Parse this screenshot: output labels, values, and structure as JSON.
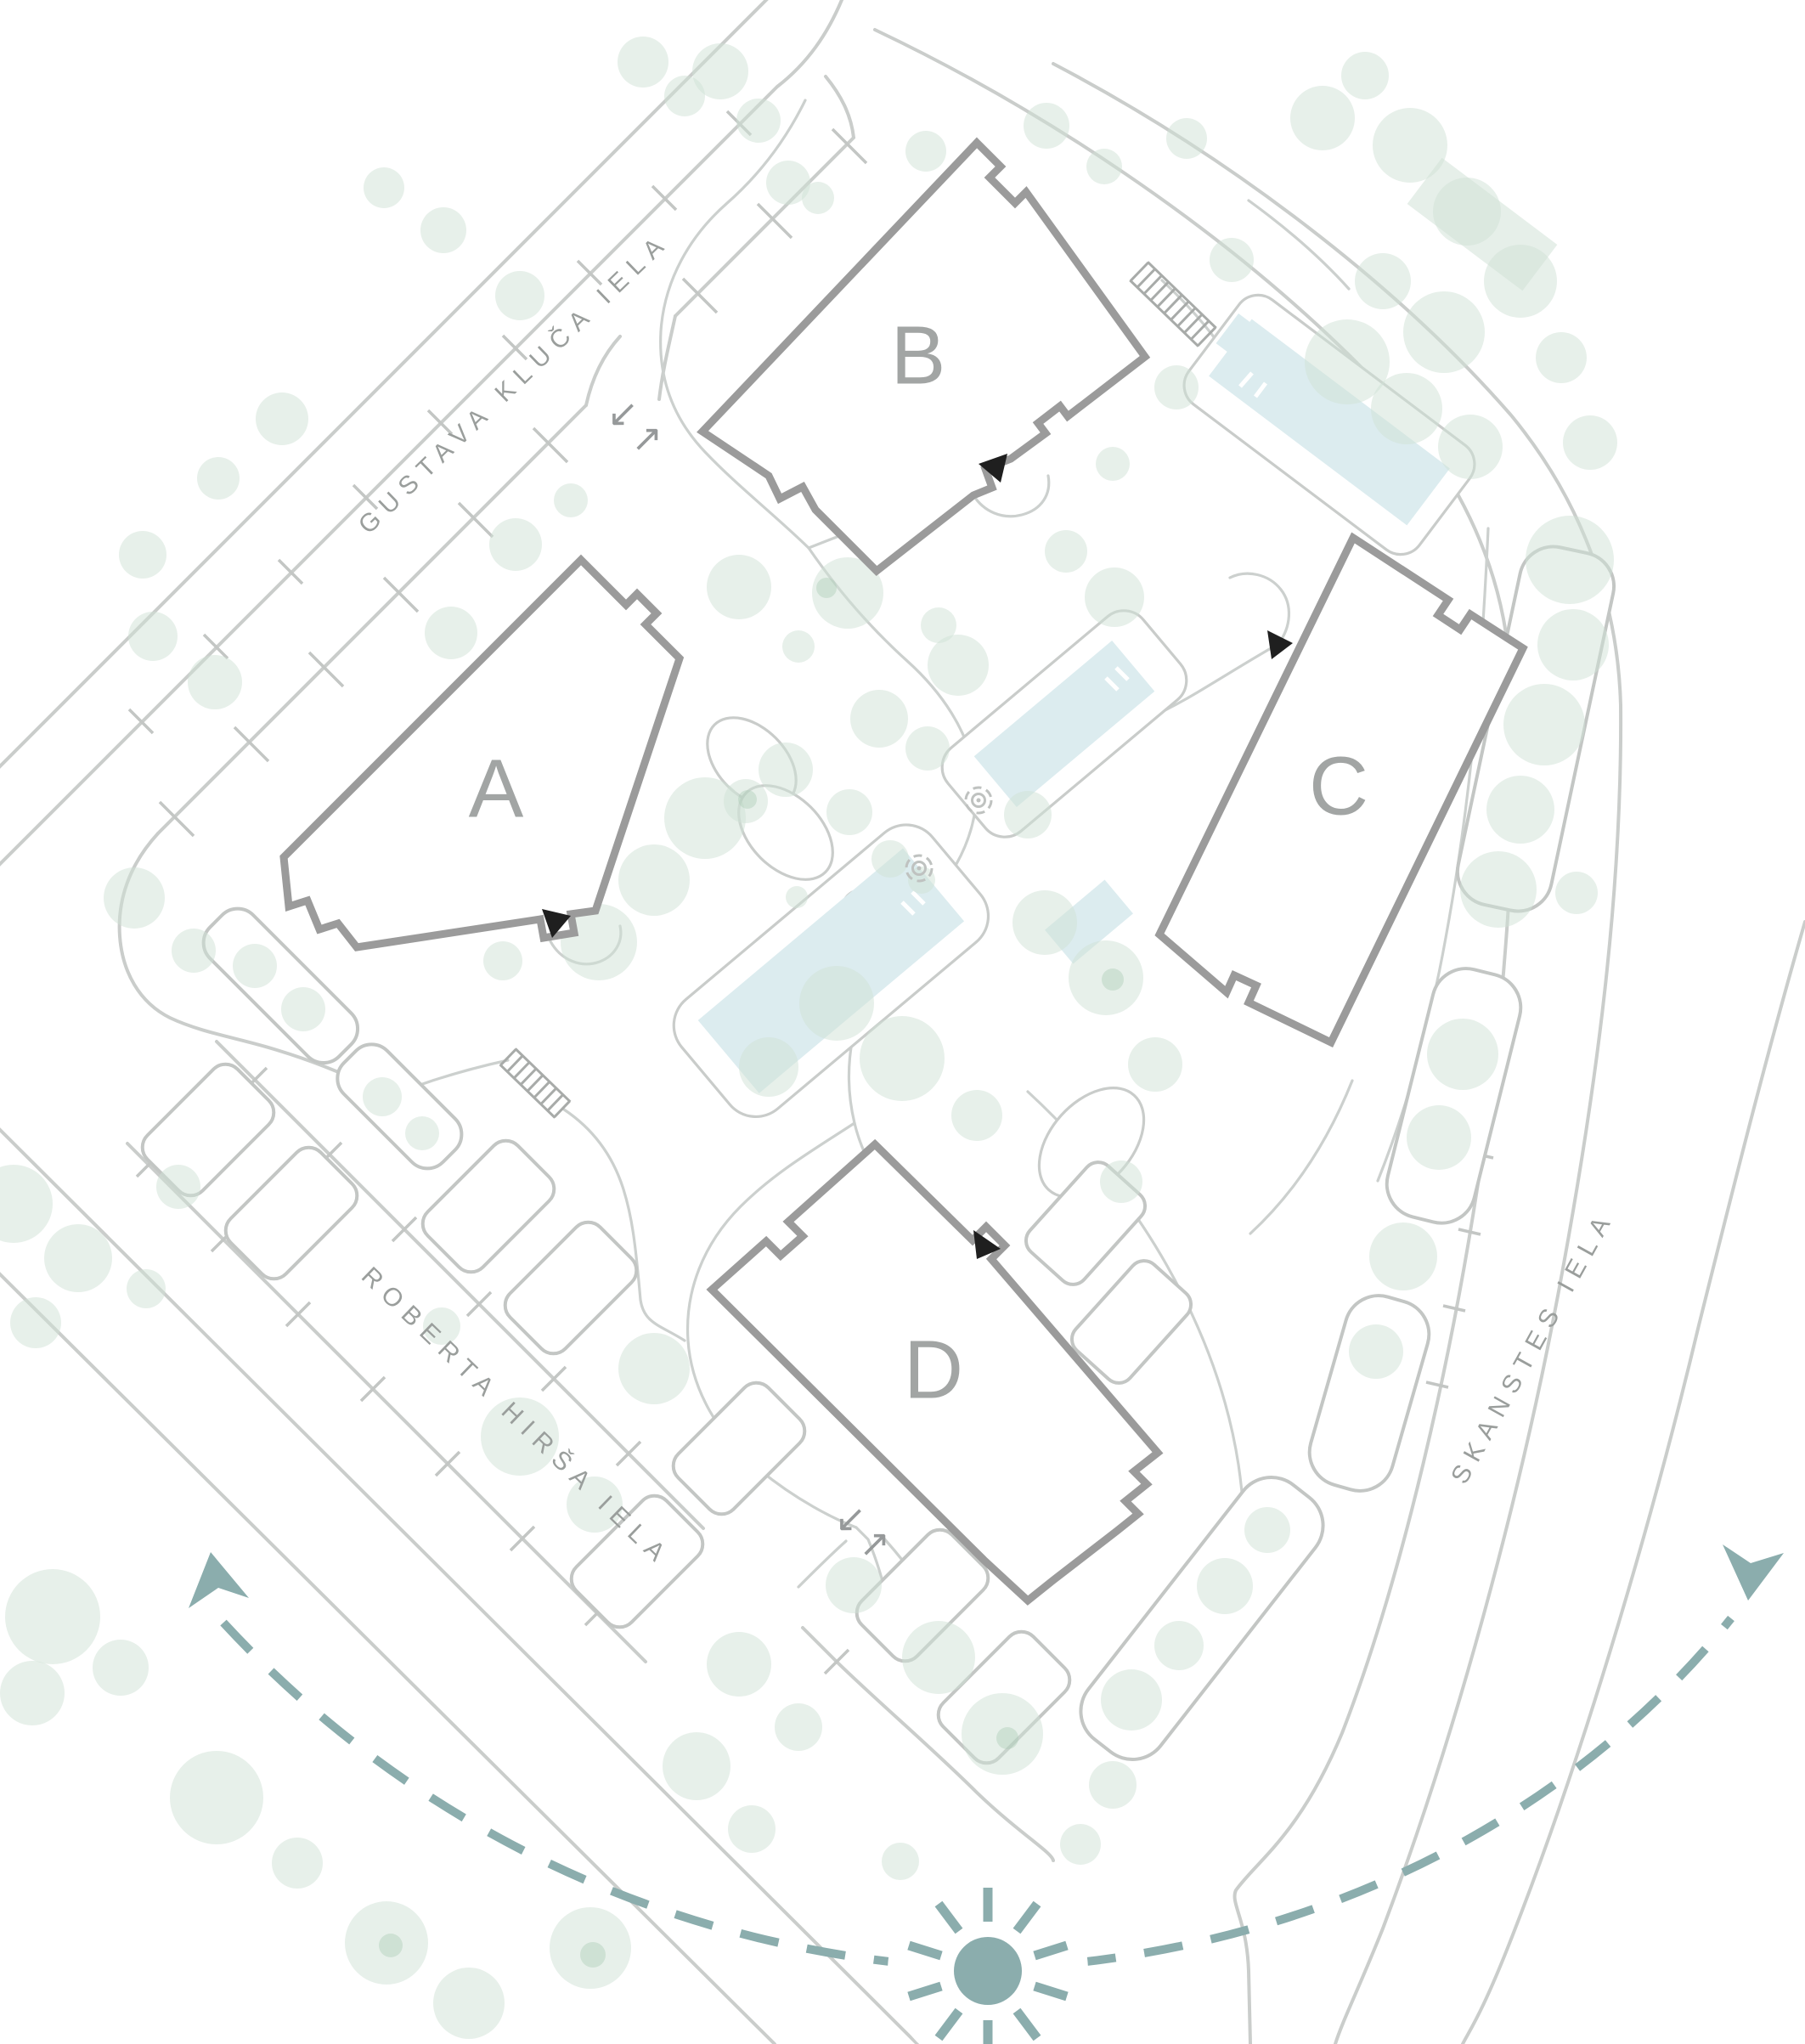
{
  "plan": {
    "streets": {
      "gustava": "GUSTAVA KLUČA IELA",
      "roberta": "ROBERTA HIRŠA IELA",
      "skanstes": "SKANSTES IELA"
    },
    "buildings": {
      "a": "A",
      "b": "B",
      "c": "C",
      "d": "D"
    },
    "ramp_arrows": "↓↑",
    "colors": {
      "road": "#cacdcb",
      "path": "#ccd0ce",
      "tick": "#c3c6c4",
      "building_outline": "#9b9b9b",
      "building_label": "#a2a5a4",
      "street_label": "#9a9e9c",
      "tree": "#cfe2d5",
      "pool": "#dcecef",
      "sun": "#8badad",
      "entrance": "#1f1f1f",
      "car": "#c3c6c4",
      "ramp": "#96999a"
    }
  }
}
